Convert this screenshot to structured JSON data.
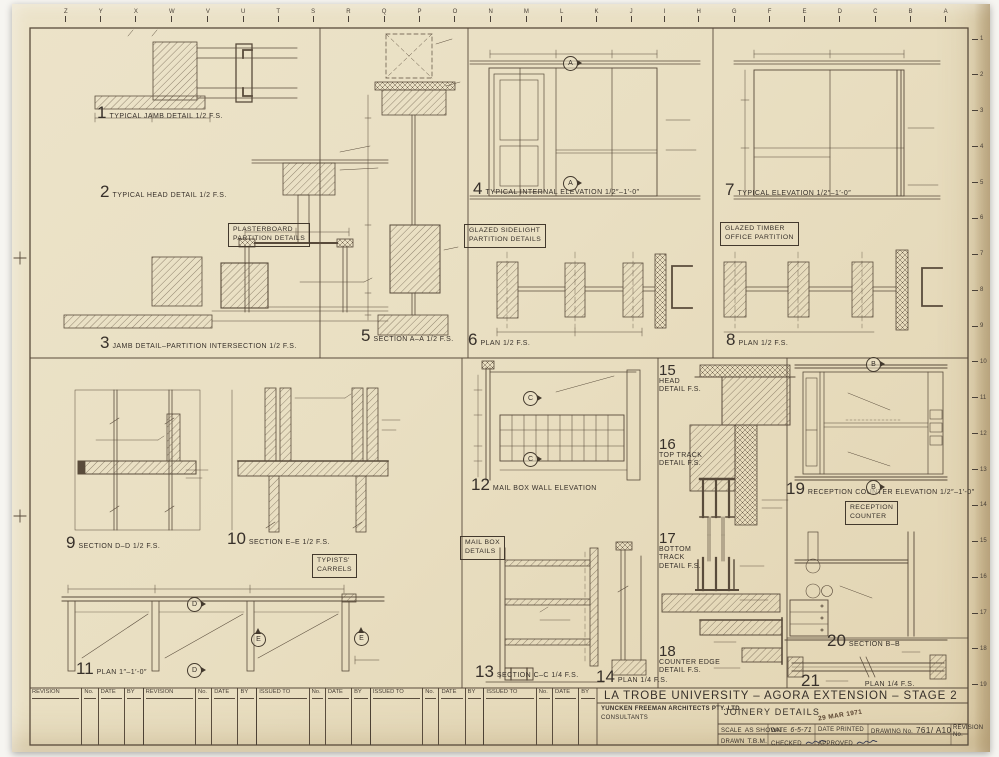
{
  "colors": {
    "paper": "#e9dfc4",
    "ink": "#43392d",
    "linework": "#594b3b"
  },
  "grid": {
    "top_letters": [
      "Z",
      "Y",
      "X",
      "W",
      "V",
      "U",
      "T",
      "S",
      "R",
      "Q",
      "P",
      "O",
      "N",
      "M",
      "L",
      "K",
      "J",
      "I",
      "H",
      "G",
      "F",
      "E",
      "D",
      "C",
      "B",
      "A"
    ],
    "right_numbers": [
      "1",
      "2",
      "3",
      "4",
      "5",
      "6",
      "7",
      "8",
      "9",
      "10",
      "11",
      "12",
      "13",
      "14",
      "15",
      "16",
      "17",
      "18",
      "19"
    ]
  },
  "markers": {
    "a": "A",
    "b": "B",
    "c": "C",
    "d": "D",
    "e": "E"
  },
  "details": [
    {
      "num": "1",
      "title": "TYPICAL JAMB DETAIL 1/2 F.S."
    },
    {
      "num": "2",
      "title": "TYPICAL HEAD DETAIL 1/2 F.S."
    },
    {
      "num": "3",
      "title": "JAMB DETAIL–PARTITION INTERSECTION 1/2 F.S."
    },
    {
      "num": "4",
      "title": "TYPICAL INTERNAL ELEVATION 1/2″–1′-0″"
    },
    {
      "num": "5",
      "title": "SECTION A–A 1/2 F.S."
    },
    {
      "num": "6",
      "title": "PLAN 1/2 F.S."
    },
    {
      "num": "7",
      "title": "TYPICAL ELEVATION 1/2″–1′-0″"
    },
    {
      "num": "8",
      "title": "PLAN 1/2 F.S."
    },
    {
      "num": "9",
      "title": "SECTION D–D 1/2 F.S."
    },
    {
      "num": "10",
      "title": "SECTION E–E 1/2 F.S."
    },
    {
      "num": "11",
      "title": "PLAN 1″–1′-0″"
    },
    {
      "num": "12",
      "title": "MAIL BOX WALL ELEVATION"
    },
    {
      "num": "13",
      "title": "SECTION C–C 1/4 F.S."
    },
    {
      "num": "14",
      "title": "PLAN 1/4 F.S."
    },
    {
      "num": "15",
      "title": "HEAD DETAIL F.S."
    },
    {
      "num": "16",
      "title": "TOP TRACK DETAIL F.S."
    },
    {
      "num": "17",
      "title": "BOTTOM TRACK DETAIL F.S."
    },
    {
      "num": "18",
      "title": "COUNTER EDGE DETAIL F.S."
    },
    {
      "num": "19",
      "title": "RECEPTION COUNTER ELEVATION 1/2″–1′-0″"
    },
    {
      "num": "20",
      "title": "SECTION B–B"
    },
    {
      "num": "21",
      "title": "PLAN 1/4 F.S."
    }
  ],
  "group_boxes": {
    "plasterboard": {
      "l1": "PLASTERBOARD",
      "l2": "PARTITION DETAILS"
    },
    "sidelight": {
      "l1": "GLAZED SIDELIGHT",
      "l2": "PARTITION DETAILS"
    },
    "timber": {
      "l1": "GLAZED TIMBER",
      "l2": "OFFICE PARTITION"
    },
    "typists": {
      "l1": "TYPISTS'",
      "l2": "CARRELS"
    },
    "mailbox": {
      "l1": "MAIL BOX",
      "l2": "DETAILS"
    },
    "reception": {
      "l1": "RECEPTION",
      "l2": "COUNTER"
    }
  },
  "title_block": {
    "project": "LA TROBE UNIVERSITY – AGORA EXTENSION – STAGE 2",
    "firm": "YUNCKEN FREEMAN ARCHITECTS PTY. LTD.",
    "consultants": "CONSULTANTS",
    "drawing_title": "JOINERY DETAILS",
    "scale_label": "SCALE",
    "scale_value": "AS SHOWN",
    "date_label": "DATE",
    "date_value": "6-5-71",
    "date_printed_label": "DATE PRINTED",
    "date_printed_stamp": "29 MAR 1971",
    "drawing_no_label": "DRAWING No.",
    "drawing_no_value": "761/ A10",
    "revision_no_label": "REVISION No.",
    "drawn_label": "DRAWN",
    "drawn_value": "T.B.M.",
    "checked_label": "CHECKED",
    "approved_label": "APPROVED"
  },
  "revision_table": {
    "groups": [
      {
        "label": "REVISION"
      },
      {
        "label": "REVISION"
      },
      {
        "label": "ISSUED TO"
      },
      {
        "label": "ISSUED TO"
      },
      {
        "label": "ISSUED TO"
      }
    ],
    "cols": {
      "no": "No.",
      "date": "DATE",
      "by": "BY"
    }
  }
}
